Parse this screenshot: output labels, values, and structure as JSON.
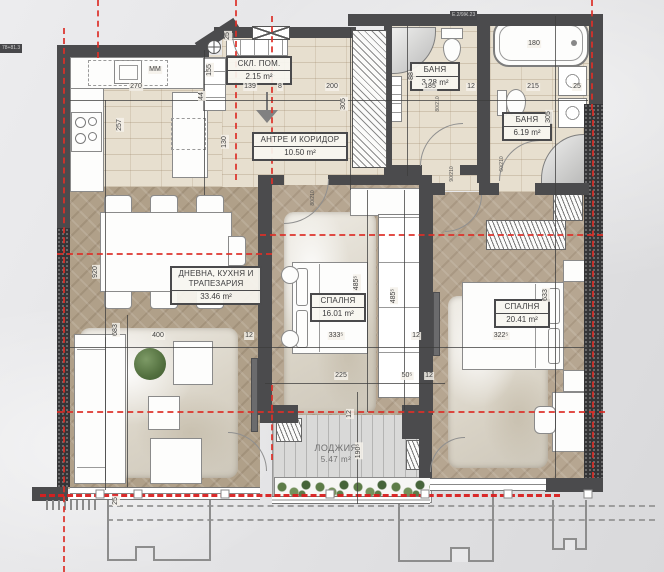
{
  "title": "apartment-floor-plan",
  "colors": {
    "wall": "#4b4b4d",
    "axis_red": "#dd2f28",
    "tile": "#e7dfcf",
    "wood": "#b0a089",
    "deck": "#d9d9d8",
    "label_border": "#4a4a4c"
  },
  "rooms": {
    "storage": {
      "name": "СКЛ. ПОМ.",
      "area": "2.15 m²"
    },
    "hallway": {
      "name": "АНТРЕ И КОРИДОР",
      "area": "10.50 m²"
    },
    "bath_small": {
      "name": "БАНЯ",
      "area": "3.28 m²"
    },
    "bath_large": {
      "name": "БАНЯ",
      "area": "6.19 m²"
    },
    "living": {
      "name": "ДНЕВНА, КУХНЯ И ТРАПЕЗАРИЯ",
      "area": "33.46 m²"
    },
    "bedroom_mid": {
      "name": "СПАЛНЯ",
      "area": "16.01 m²"
    },
    "bedroom_right": {
      "name": "СПАЛНЯ",
      "area": "20.41 m²"
    },
    "loggia": {
      "name": "ЛОДЖИЯ",
      "area": "5.47 m²"
    }
  },
  "dims": [
    {
      "t": "270",
      "x": 136,
      "y": 87
    },
    {
      "t": "139",
      "x": 250,
      "y": 87
    },
    {
      "t": "8",
      "x": 280,
      "y": 87
    },
    {
      "t": "200",
      "x": 332,
      "y": 87
    },
    {
      "t": "185",
      "x": 430,
      "y": 87
    },
    {
      "t": "12",
      "x": 471,
      "y": 87
    },
    {
      "t": "215",
      "x": 533,
      "y": 87
    },
    {
      "t": "25",
      "x": 577,
      "y": 87
    },
    {
      "t": "180",
      "x": 534,
      "y": 44
    },
    {
      "t": "ММ",
      "x": 155,
      "y": 70
    },
    {
      "t": "257",
      "x": 120,
      "y": 125,
      "r": 1
    },
    {
      "t": "25",
      "x": 228,
      "y": 36,
      "r": 1
    },
    {
      "t": "155",
      "x": 210,
      "y": 70,
      "r": 1
    },
    {
      "t": "44",
      "x": 202,
      "y": 96,
      "r": 1
    },
    {
      "t": "130",
      "x": 225,
      "y": 142,
      "r": 1
    },
    {
      "t": "305",
      "x": 344,
      "y": 104,
      "r": 1
    },
    {
      "t": "88",
      "x": 412,
      "y": 76,
      "r": 1
    },
    {
      "t": "305",
      "x": 549,
      "y": 117,
      "r": 1
    },
    {
      "t": "920",
      "x": 96,
      "y": 272,
      "r": 1
    },
    {
      "t": "683",
      "x": 116,
      "y": 330,
      "r": 1
    },
    {
      "t": "485⁵",
      "x": 357,
      "y": 283,
      "r": 1
    },
    {
      "t": "485⁵",
      "x": 394,
      "y": 296,
      "r": 1
    },
    {
      "t": "633",
      "x": 546,
      "y": 295,
      "r": 1
    },
    {
      "t": "12",
      "x": 350,
      "y": 414,
      "r": 1
    },
    {
      "t": "190⁵",
      "x": 359,
      "y": 451,
      "r": 1
    },
    {
      "t": "25",
      "x": 116,
      "y": 501,
      "r": 1
    },
    {
      "t": "400",
      "x": 158,
      "y": 336
    },
    {
      "t": "12",
      "x": 249,
      "y": 336
    },
    {
      "t": "333⁵",
      "x": 336,
      "y": 336
    },
    {
      "t": "12",
      "x": 416,
      "y": 336
    },
    {
      "t": "322⁵",
      "x": 501,
      "y": 336
    },
    {
      "t": "225",
      "x": 341,
      "y": 376
    },
    {
      "t": "50⁵",
      "x": 407,
      "y": 376
    },
    {
      "t": "12",
      "x": 429,
      "y": 376
    }
  ],
  "door_specs": [
    {
      "t": "80/210",
      "x": 438,
      "y": 104,
      "r": 1
    },
    {
      "t": "90/210",
      "x": 452,
      "y": 174,
      "r": 1
    },
    {
      "t": "60/210",
      "x": 502,
      "y": 164,
      "r": 1
    },
    {
      "t": "80/210",
      "x": 313,
      "y": 198,
      "r": 1
    }
  ],
  "wall_tags": [
    {
      "t": "78+81.3",
      "x": 0,
      "y": 44
    },
    {
      "t": "Е.2/9Ж.23",
      "x": 450,
      "y": 11
    }
  ],
  "railing_posts": [
    {
      "x": 100,
      "y": 494
    },
    {
      "x": 138,
      "y": 494
    },
    {
      "x": 225,
      "y": 494
    },
    {
      "x": 330,
      "y": 494
    },
    {
      "x": 425,
      "y": 494
    },
    {
      "x": 508,
      "y": 494
    },
    {
      "x": 588,
      "y": 494
    }
  ]
}
